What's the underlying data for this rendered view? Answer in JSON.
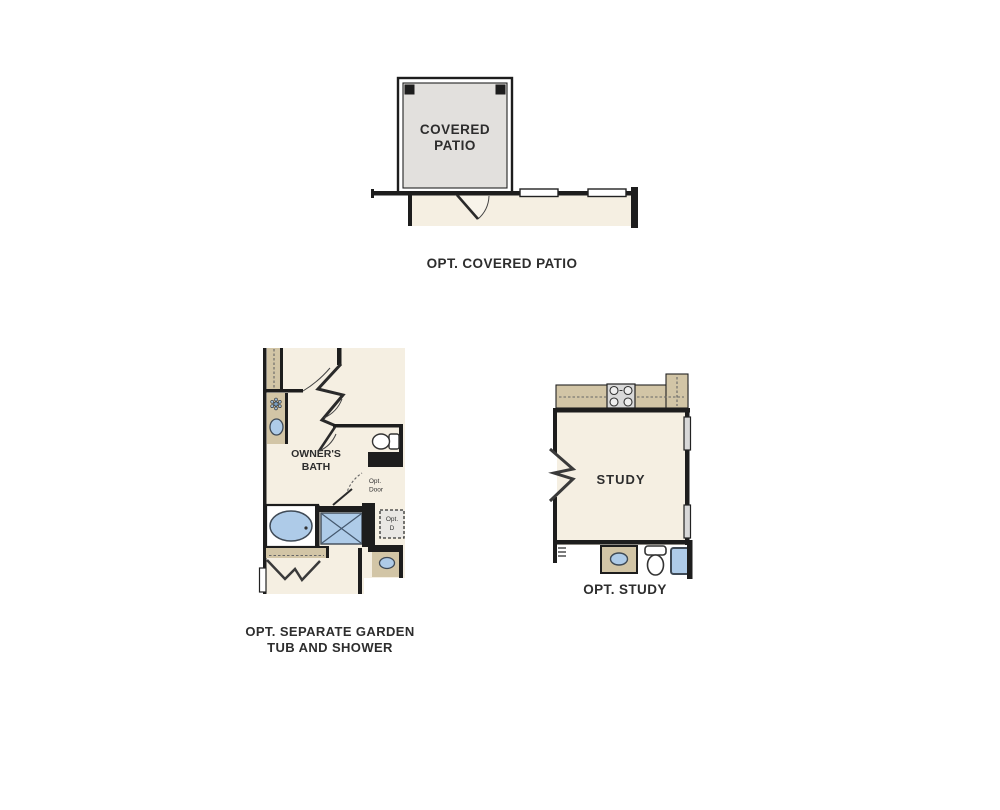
{
  "figures": {
    "patio": {
      "room_label_line1": "COVERED",
      "room_label_line2": "PATIO",
      "caption": "OPT. COVERED PATIO"
    },
    "bath": {
      "room_label_line1": "OWNER'S",
      "room_label_line2": "BATH",
      "opt_door_line1": "Opt.",
      "opt_door_line2": "Door",
      "opt_d_line1": "Opt.",
      "opt_d_line2": "D",
      "caption_line1": "OPT. SEPARATE GARDEN",
      "caption_line2": "TUB AND SHOWER"
    },
    "study": {
      "room_label": "STUDY",
      "caption": "OPT. STUDY"
    }
  },
  "icons": {
    "sink-icon": "blue ellipse in counter",
    "tub-icon": "blue oval in white rect",
    "shower-icon": "blue square with X",
    "toilet-icon": "tank and bowl outline",
    "cooktop-icon": "gray box with four burner circles",
    "window-symbol": "double-line rectangle in wall",
    "door-swing-icon": "panel line with quarter arc",
    "wall-break-icon": "zigzag chevron",
    "light-fixture-icon": "small flower cluster",
    "column-icon": "solid black square"
  },
  "colors": {
    "background": "#ffffff",
    "wall": "#1d1d1d",
    "interior": "#f5efe2",
    "counter": "#d2c5a6",
    "patio_fill": "#e2e0dd",
    "fixture_blue": "#aecbe8",
    "fixture_stroke": "#3f4a56",
    "text": "#2d2d2d",
    "opt_box_fill": "#e9e7e4",
    "cooktop_fill": "#d9d9d9",
    "window_fill": "#d8d8d8"
  }
}
